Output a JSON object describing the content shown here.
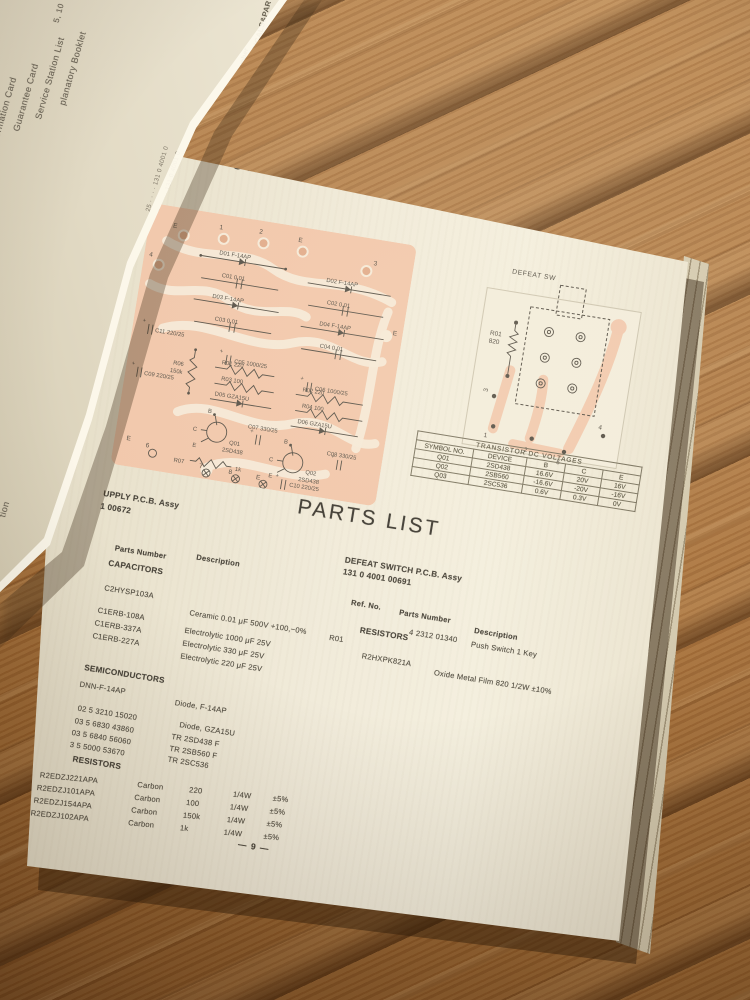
{
  "titles": {
    "power_board": "OWER SUPPLY P.C.BOARD",
    "defeat_board": "DEFEAT SWITCH P.C.BOARD"
  },
  "power_pcb": {
    "labels": [
      "E",
      "1",
      "2",
      "E",
      "3",
      "4",
      "E",
      "D01  F-14AP",
      "C01  0.01",
      "D03  F-14AP",
      "C03  0.01",
      "D02  F-14AP",
      "C02  0.01",
      "D04  F-14AP",
      "C04  0.01",
      "C05  1000/25",
      "C06  1000/25",
      "R06",
      "150k",
      "C11  220/25",
      "C09  220/25",
      "R01  220",
      "R03  100",
      "D05  GZA15U",
      "R02  220",
      "R04  100",
      "D06  GZA15U",
      "B",
      "C",
      "E",
      "Q01",
      "2SD438",
      "C07  330/25",
      "R07",
      "1k",
      "B",
      "C",
      "E",
      "Q02",
      "2SD438",
      "C08  330/25",
      "6",
      "E",
      "7",
      "8",
      "E",
      "C10  220/25"
    ]
  },
  "defeat_pcb": {
    "labels": [
      "DEFEAT SW",
      "R01",
      "820",
      "3",
      "1",
      "2",
      "5",
      "4"
    ]
  },
  "voltage_table": {
    "title": "TRANSISTOR DC VOLTAGES",
    "headers": [
      "SYMBOL NO.",
      "DEVICE",
      "B",
      "C",
      "E"
    ],
    "rows": [
      [
        "Q01",
        "2SD438",
        "16.6V",
        "20V",
        "16V"
      ],
      [
        "Q02",
        "2SB560",
        "-16.6V",
        "-20V",
        "-16V"
      ],
      [
        "Q03",
        "2SC536",
        "0.6V",
        "0.3V",
        "0V"
      ]
    ]
  },
  "parts_list": {
    "heading": "PARTS LIST",
    "left": {
      "assy": "UPPLY P.C.B. Assy",
      "assy_no": "1 00672",
      "col_parts": "Parts Number",
      "col_desc": "Description",
      "capacitors_title": "CAPACITORS",
      "cap_rows": [
        [
          "C2HYSP103A",
          "Ceramic   0.01 μF 500V   +100,−0%"
        ],
        [
          "C1ERB-108A",
          "Electrolytic 1000 μF   25V"
        ],
        [
          "C1ERB-337A",
          "Electrolytic   330 μF   25V"
        ],
        [
          "C1ERB-227A",
          "Electrolytic   220 μF   25V"
        ]
      ],
      "semiconductors_title": "SEMICONDUCTORS",
      "semi_rows": [
        [
          "DNN-F-14AP",
          "Diode, F-14AP"
        ],
        [
          "02 5 3210 15020",
          "Diode, GZA15U"
        ],
        [
          "03 5 6830 43860",
          "TR 2SD438 F"
        ],
        [
          "03 5 6840 56060",
          "TR 2SB560 F"
        ],
        [
          "3 5 5000 53670",
          "TR 2SC536"
        ]
      ],
      "resistors_title": "RESISTORS",
      "res_rows": [
        [
          "R2EDZJ221APA",
          "Carbon",
          "220",
          "1/4W",
          "±5%"
        ],
        [
          "R2EDZJ101APA",
          "Carbon",
          "100",
          "1/4W",
          "±5%"
        ],
        [
          "R2EDZJ154APA",
          "Carbon",
          "150k",
          "1/4W",
          "±5%"
        ],
        [
          "R2EDZJ102APA",
          "Carbon",
          "1k",
          "1/4W",
          "±5%"
        ]
      ]
    },
    "right": {
      "assy": "DEFEAT SWITCH P.C.B. Assy",
      "assy_no": "131 0 4001 00691",
      "col_ref": "Ref. No.",
      "col_parts": "Parts Number",
      "col_desc": "Description",
      "switch_no": "4 2312 01340",
      "switch_desc": "Push Switch 1 Key",
      "ref": "R01",
      "resistors_title": "RESISTORS",
      "res_no": "R2HXPK821A",
      "res_desc": "Oxide Metal Film 820  1/2W  ±10%"
    }
  },
  "page_number": "— 9 —",
  "under_page": {
    "heading": "ECTRICALS&PARTS LIS",
    "col_header": "Ref. No.   Parts Number",
    "items": [
      "5, 10",
      "planatory Booklet",
      "Service Station List",
      "Guarantee Card",
      "nformation Card",
      "tion"
    ],
    "number_lines": [
      "25 · · · · 131 0 4001 0",
      "25 · · · · 131 0 4001 0",
      "2S · · · · 131 0 4001 0",
      "25 · · · · 131 0 4001 0",
      "25 · · · · 131 0 4001 0",
      "2S · · · · 131 0 4001 0",
      "25 · · · · 131 0 4001 0",
      "25 · · · · 131 0 4001 0"
    ]
  },
  "colors": {
    "wood": "#a9743f",
    "paper": "#f1ebda",
    "pcb_trace_pink": "#f2c8ac",
    "ink": "#5a544a"
  }
}
